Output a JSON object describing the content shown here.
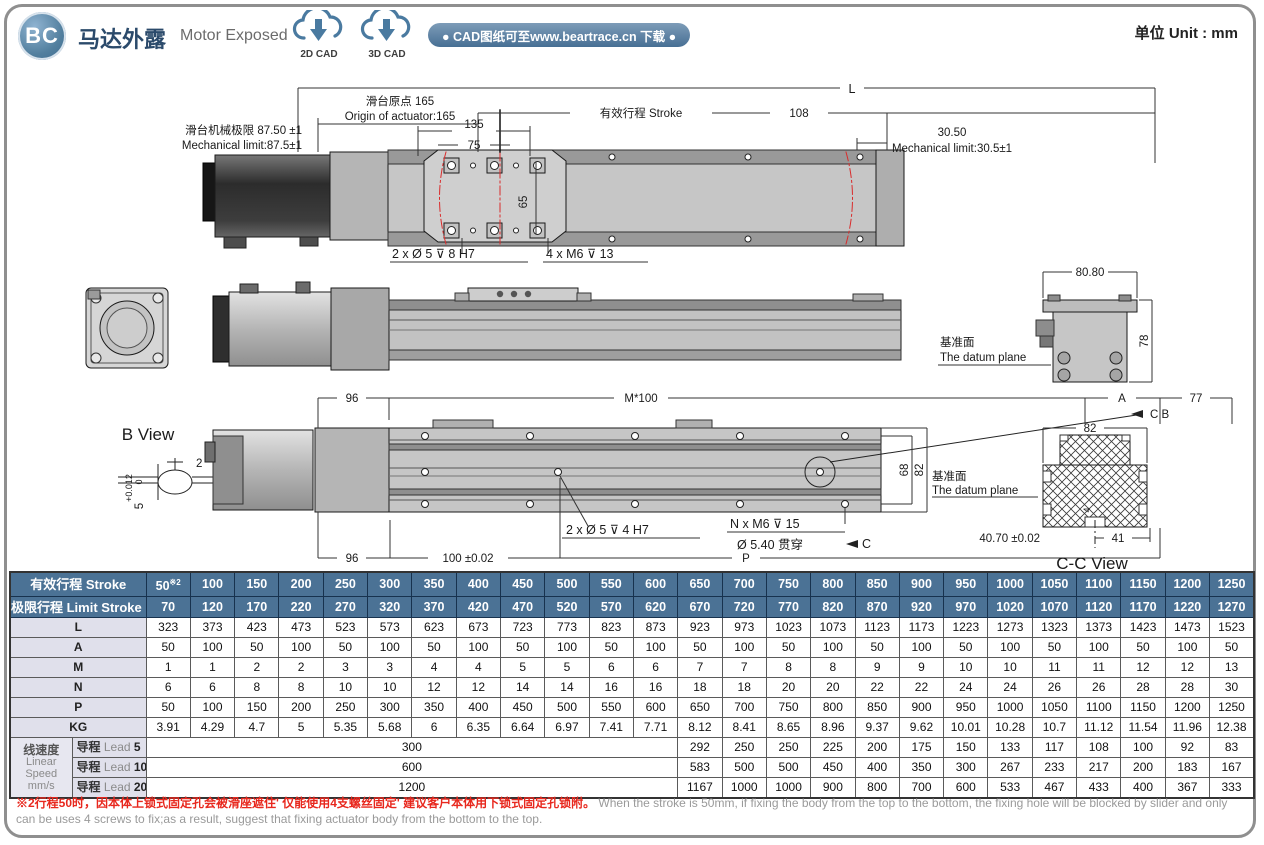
{
  "page": {
    "badge": "BC",
    "title_cn": "马达外露",
    "title_en": "Motor Exposed",
    "cad_2d": "2D CAD",
    "cad_3d": "3D CAD",
    "cad_banner": "● CAD图纸可至www.beartrace.cn 下载 ●",
    "unit": "单位  Unit : mm"
  },
  "drawings": {
    "top_view": {
      "dim_L": "L",
      "origin_cn": "滑台原点 165",
      "origin_en": "Origin of actuator:165",
      "stroke_label": "有效行程 Stroke",
      "dim_108": "108",
      "dim_135": "135",
      "dim_75": "75",
      "dim_65": "65",
      "mech_left_cn": "滑台机械极限 87.50 ±1",
      "mech_left_en": "Mechanical limit:87.5±1",
      "mech_right_val": "30.50",
      "mech_right_en": "Mechanical limit:30.5±1",
      "callout_counterbore": "2 x Ø 5 ⊽ 8 H7",
      "callout_tap": "4 x M6 ⊽ 13"
    },
    "side_view": {
      "dim_8080": "80.80",
      "dim_78": "78",
      "datum_cn": "基准面",
      "datum_en": "The datum plane"
    },
    "bottom_view": {
      "dim_96_top": "96",
      "dim_m100": "M*100",
      "dim_A": "A",
      "dim_77": "77",
      "label_cb": "C B",
      "dim_68": "68",
      "dim_82": "82",
      "datum_cn": "基准面",
      "datum_en": "The datum plane",
      "callout_dowel": "2 x Ø 5 ⊽ 4 H7",
      "callout_tap": "N x M6 ⊽ 15",
      "callout_thru": "Ø 5.40 贯穿",
      "label_c": "C",
      "dim_96_bottom": "96",
      "dim_100": "100 ±0.02",
      "dim_P": "P"
    },
    "b_view": {
      "label": "B View",
      "dim_2": "2",
      "dim_5": "5",
      "tol_upper": "+0.012",
      "tol_lower": "0"
    },
    "cc_view": {
      "dim_82": "82",
      "dim_4": "4",
      "dim_4070": "40.70 ±0.02",
      "dim_41": "41",
      "label": "C-C View"
    }
  },
  "table": {
    "stroke_label": "有效行程  Stroke",
    "stroke_note": "※2",
    "limit_label": "极限行程 Limit Stroke (±1)",
    "stroke": [
      "50",
      "100",
      "150",
      "200",
      "250",
      "300",
      "350",
      "400",
      "450",
      "500",
      "550",
      "600",
      "650",
      "700",
      "750",
      "800",
      "850",
      "900",
      "950",
      "1000",
      "1050",
      "1100",
      "1150",
      "1200",
      "1250"
    ],
    "limit": [
      "70",
      "120",
      "170",
      "220",
      "270",
      "320",
      "370",
      "420",
      "470",
      "520",
      "570",
      "620",
      "670",
      "720",
      "770",
      "820",
      "870",
      "920",
      "970",
      "1020",
      "1070",
      "1120",
      "1170",
      "1220",
      "1270"
    ],
    "rows": [
      {
        "label": "L",
        "values": [
          "323",
          "373",
          "423",
          "473",
          "523",
          "573",
          "623",
          "673",
          "723",
          "773",
          "823",
          "873",
          "923",
          "973",
          "1023",
          "1073",
          "1123",
          "1173",
          "1223",
          "1273",
          "1323",
          "1373",
          "1423",
          "1473",
          "1523"
        ]
      },
      {
        "label": "A",
        "values": [
          "50",
          "100",
          "50",
          "100",
          "50",
          "100",
          "50",
          "100",
          "50",
          "100",
          "50",
          "100",
          "50",
          "100",
          "50",
          "100",
          "50",
          "100",
          "50",
          "100",
          "50",
          "100",
          "50",
          "100",
          "50"
        ]
      },
      {
        "label": "M",
        "values": [
          "1",
          "1",
          "2",
          "2",
          "3",
          "3",
          "4",
          "4",
          "5",
          "5",
          "6",
          "6",
          "7",
          "7",
          "8",
          "8",
          "9",
          "9",
          "10",
          "10",
          "11",
          "11",
          "12",
          "12",
          "13"
        ]
      },
      {
        "label": "N",
        "values": [
          "6",
          "6",
          "8",
          "8",
          "10",
          "10",
          "12",
          "12",
          "14",
          "14",
          "16",
          "16",
          "18",
          "18",
          "20",
          "20",
          "22",
          "22",
          "24",
          "24",
          "26",
          "26",
          "28",
          "28",
          "30"
        ]
      },
      {
        "label": "P",
        "values": [
          "50",
          "100",
          "150",
          "200",
          "250",
          "300",
          "350",
          "400",
          "450",
          "500",
          "550",
          "600",
          "650",
          "700",
          "750",
          "800",
          "850",
          "900",
          "950",
          "1000",
          "1050",
          "1100",
          "1150",
          "1200",
          "1250"
        ]
      },
      {
        "label": "KG",
        "values": [
          "3.91",
          "4.29",
          "4.7",
          "5",
          "5.35",
          "5.68",
          "6",
          "6.35",
          "6.64",
          "6.97",
          "7.41",
          "7.71",
          "8.12",
          "8.41",
          "8.65",
          "8.96",
          "9.37",
          "9.62",
          "10.01",
          "10.28",
          "10.7",
          "11.12",
          "11.54",
          "11.96",
          "12.38"
        ]
      }
    ],
    "speed_group": {
      "cn": "线速度",
      "en1": "Linear",
      "en2": "Speed",
      "en3": "mm/s"
    },
    "leads": [
      {
        "label_cn": "导程",
        "label_en": "Lead",
        "num": "5",
        "merged": "300",
        "values": [
          "292",
          "250",
          "250",
          "225",
          "200",
          "175",
          "150",
          "133",
          "117",
          "108",
          "100",
          "92",
          "83"
        ]
      },
      {
        "label_cn": "导程",
        "label_en": "Lead",
        "num": "10",
        "merged": "600",
        "values": [
          "583",
          "500",
          "500",
          "450",
          "400",
          "350",
          "300",
          "267",
          "233",
          "217",
          "200",
          "183",
          "167"
        ]
      },
      {
        "label_cn": "导程",
        "label_en": "Lead",
        "num": "20",
        "merged": "1200",
        "values": [
          "1167",
          "1000",
          "1000",
          "900",
          "800",
          "700",
          "600",
          "533",
          "467",
          "433",
          "400",
          "367",
          "333"
        ]
      }
    ]
  },
  "footer": {
    "cn": "※2行程50时，因本体上锁式固定孔会被滑座遮住' 仅能使用4支螺丝固定' 建议客户本体用下锁式固定孔锁附。",
    "en": "When the stroke is 50mm, if fixing the body from the top to the bottom, the fixing hole will be blocked by slider and only can be uses 4 screws to fix;as a result, suggest that fixing actuator body from the bottom to the top."
  }
}
